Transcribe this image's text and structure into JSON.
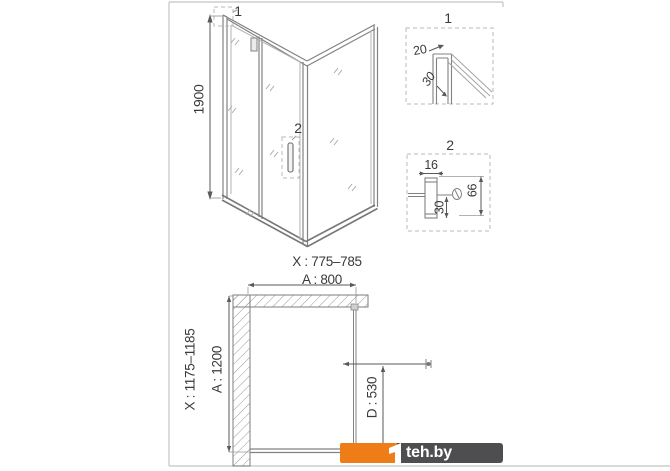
{
  "colors": {
    "accent_orange": "#ee7d17",
    "watermark_bar": "#4e4e50",
    "drawing_line": "#828282",
    "dimension_text": "#3a3a3a",
    "frame_border": "#c4c4c4"
  },
  "front_view": {
    "detail_callout_1": "1",
    "detail_callout_2": "2",
    "height_dim": "1900",
    "width_adjust_dim": "X : 775–785",
    "width_dim": "A : 800"
  },
  "detail_1": {
    "title": "1",
    "profile_width_dim": "20",
    "profile_depth_dim": "30"
  },
  "detail_2": {
    "title": "2",
    "profile_width_dim": "16",
    "handle_offset_dim": "30",
    "handle_depth_dim": "66"
  },
  "plan_view": {
    "depth_adjust_dim": "X : 1175–1185",
    "depth_dim": "A : 1200",
    "door_opening_dim": "D : 530"
  },
  "watermark": {
    "brand": "teh.by"
  }
}
